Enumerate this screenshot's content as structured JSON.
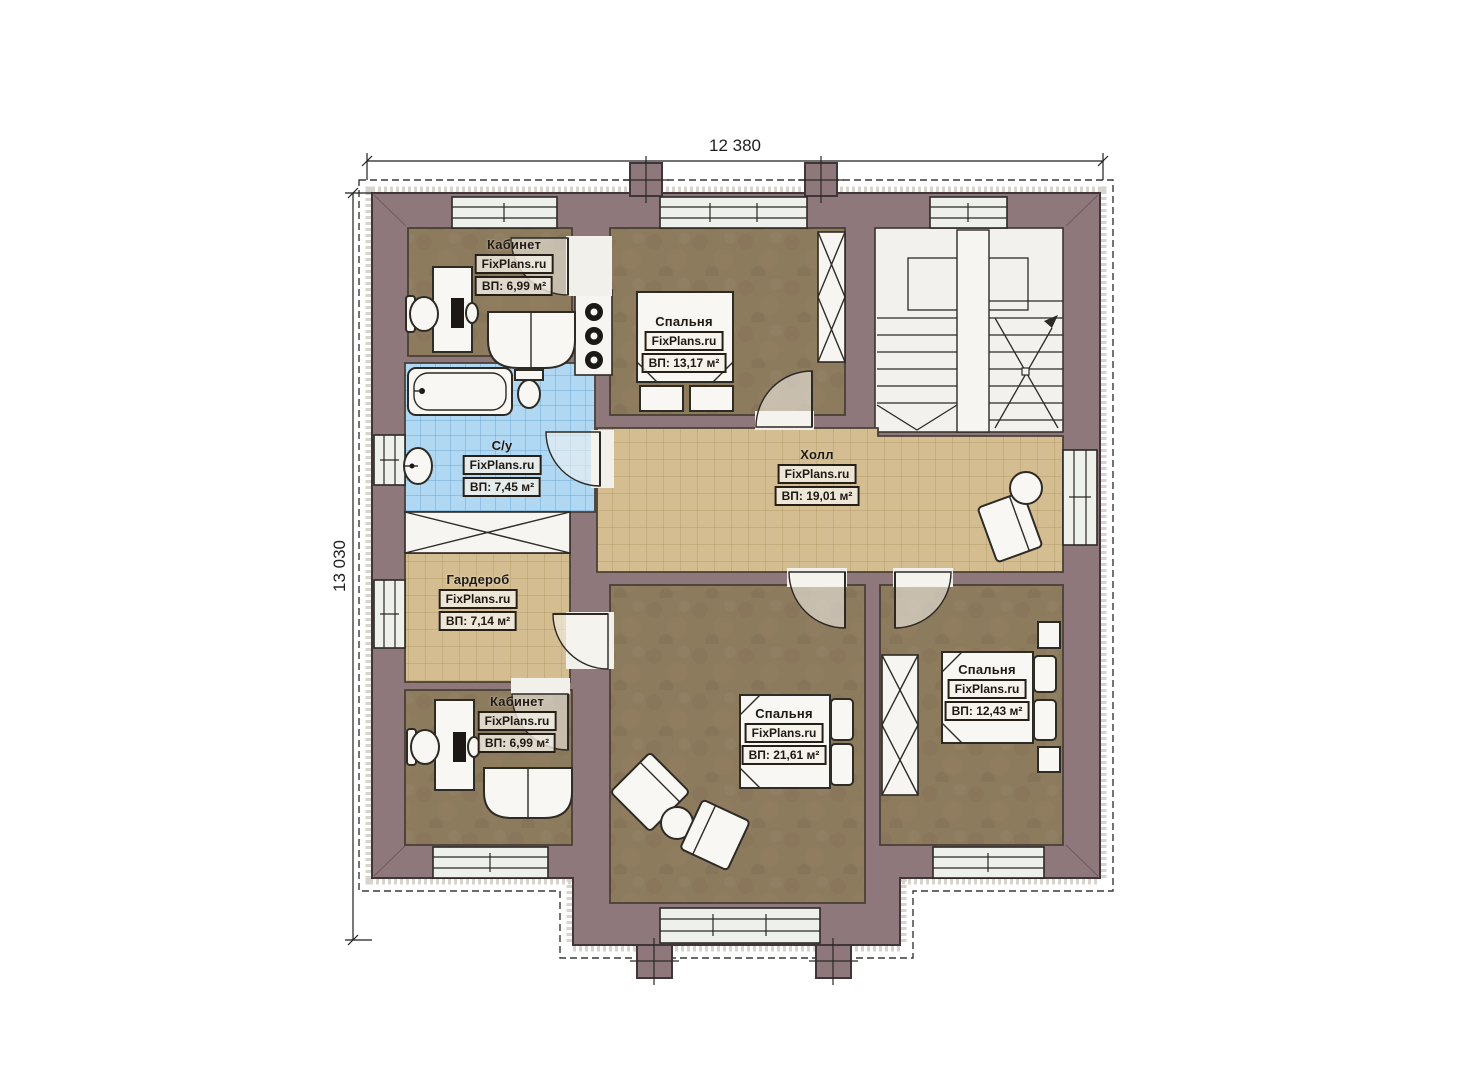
{
  "plan": {
    "brand": "FixPlans.ru",
    "dimensions": {
      "width": "12 380",
      "height": "13 030"
    },
    "rooms": [
      {
        "key": "office-top",
        "name": "Кабинет",
        "brand": "FixPlans.ru",
        "area": "ВП: 6,99 м²"
      },
      {
        "key": "bedroom-top",
        "name": "Спальня",
        "brand": "FixPlans.ru",
        "area": "ВП: 13,17 м²"
      },
      {
        "key": "bathroom",
        "name": "С/у",
        "brand": "FixPlans.ru",
        "area": "ВП: 7,45 м²"
      },
      {
        "key": "hall",
        "name": "Холл",
        "brand": "FixPlans.ru",
        "area": "ВП: 19,01 м²"
      },
      {
        "key": "wardrobe",
        "name": "Гардероб",
        "brand": "FixPlans.ru",
        "area": "ВП: 7,14 м²"
      },
      {
        "key": "office-bottom",
        "name": "Кабинет",
        "brand": "FixPlans.ru",
        "area": "ВП: 6,99 м²"
      },
      {
        "key": "bedroom-middle",
        "name": "Спальня",
        "brand": "FixPlans.ru",
        "area": "ВП: 21,61 м²"
      },
      {
        "key": "bedroom-right",
        "name": "Спальня",
        "brand": "FixPlans.ru",
        "area": "ВП: 12,43 м²"
      }
    ],
    "colors": {
      "wall": "#8e787b",
      "floor_wood": "#8d7b5e",
      "tile_tan": "#d4be91",
      "tile_blue": "#b0d8f3",
      "stairs_floor": "#f2f1ee"
    }
  }
}
